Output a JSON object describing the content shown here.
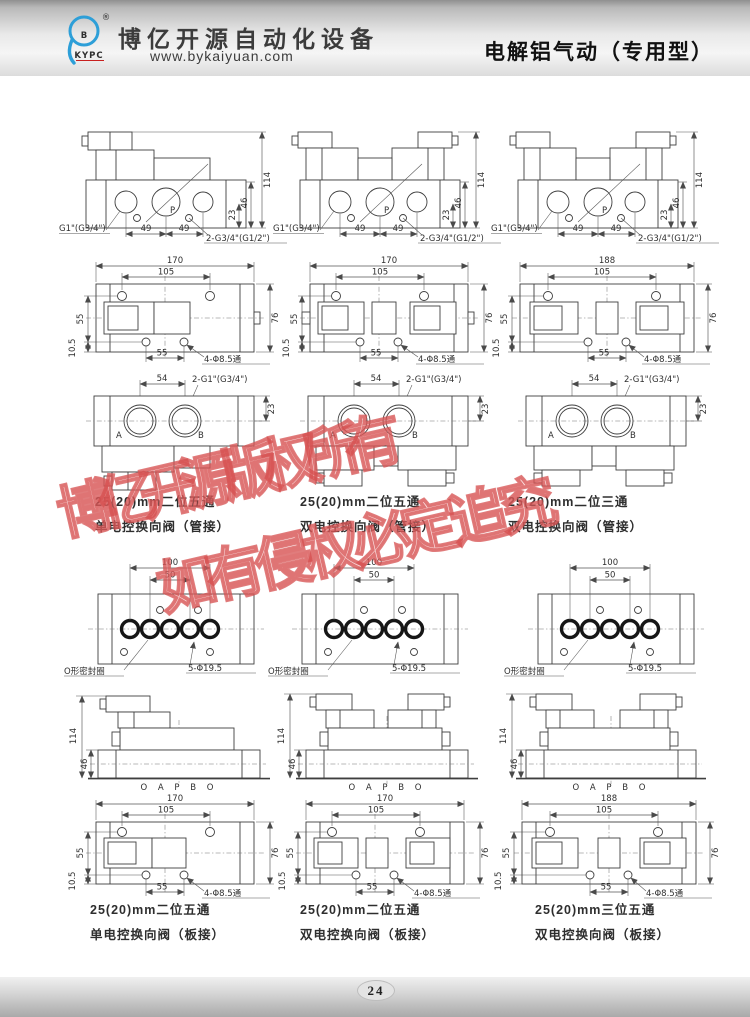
{
  "header": {
    "logo": {
      "b": "B",
      "sub": "KYPC",
      "reg": "®"
    },
    "company": "博亿开源自动化设备",
    "website": "www.bykaiyuan.com",
    "title": "电解铝气动（专用型）"
  },
  "watermark": {
    "line1": "博亿开源版权所有",
    "line2": "如有侵权必定追究"
  },
  "dims": {
    "d114": "114",
    "d46": "46",
    "d23": "23",
    "d49": "49",
    "d54": "54",
    "d170": "170",
    "d188": "188",
    "d105": "105",
    "d55": "55",
    "d76": "76",
    "d10_5": "10.5",
    "d100": "100",
    "d50": "50",
    "port_g1": "G1\"(G3/4\")",
    "port_2g34": "2-G3/4\"(G1/2\")",
    "port_2g1": "2-G1\"(G3/4\")",
    "holes_85": "4-Φ8.5通",
    "holes_195": "5-Φ19.5",
    "oring_label": "O形密封圈",
    "oapbo": "O A P B O",
    "pA": "A",
    "pB": "B",
    "pP": "P"
  },
  "captions_top": [
    {
      "line1": "25(20)mm二位五通",
      "line2": "单电控换向阀（管接）"
    },
    {
      "line1": "25(20)mm二位五通",
      "line2": "双电控换向阀（管接）"
    },
    {
      "line1": "25(20)mm二位三通",
      "line2": "双电控换向阀（管接）"
    }
  ],
  "captions_bottom": [
    {
      "line1": "25(20)mm二位五通",
      "line2": "单电控换向阀（板接）"
    },
    {
      "line1": "25(20)mm二位五通",
      "line2": "双电控换向阀（板接）"
    },
    {
      "line1": "25(20)mm三位五通",
      "line2": "双电控换向阀（板接）"
    }
  ],
  "footer": {
    "page": "24"
  }
}
